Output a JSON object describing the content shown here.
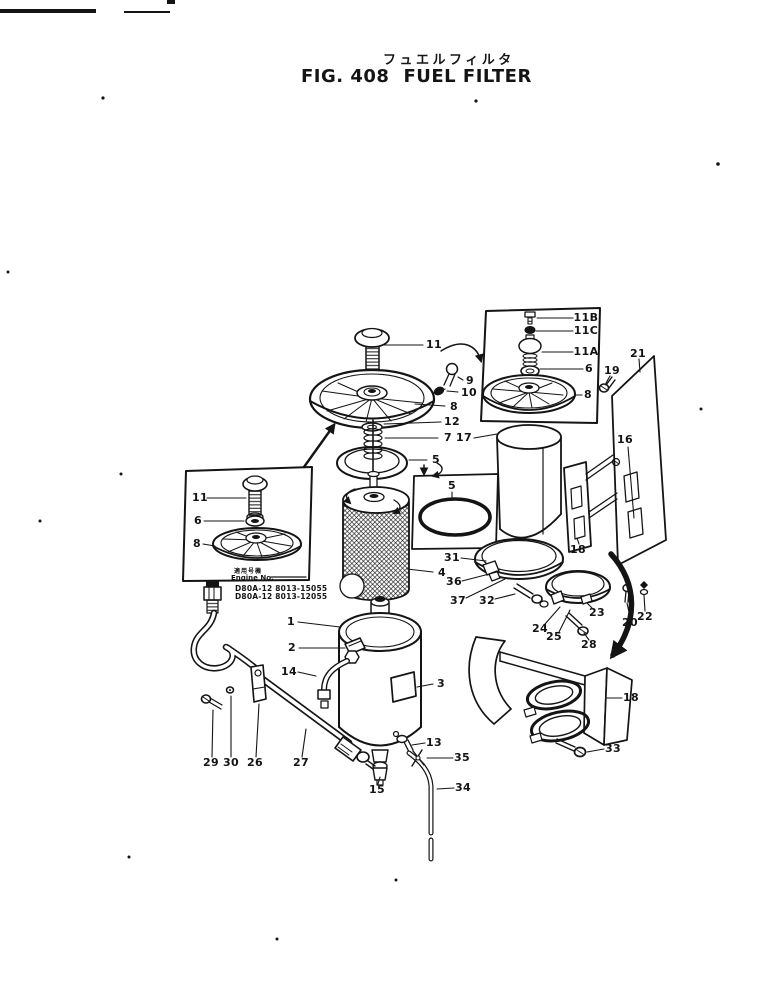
{
  "page": {
    "title_jp": "フュエルフィルタ",
    "fig_no": "FIG. 408",
    "title_en": "FUEL FILTER"
  },
  "engine_box": {
    "applicable_label": "適用号機",
    "engine_no_label": "Engine No.",
    "serials": [
      "D80A-12 8013-15055",
      "D80A-12 8013-12055"
    ]
  },
  "colors": {
    "ink": "#141414",
    "paper": "#ffffff"
  },
  "callouts": [
    {
      "t": "11",
      "x": 434,
      "y": 345,
      "l": [
        382,
        345,
        423,
        345
      ]
    },
    {
      "t": "9",
      "x": 470,
      "y": 381,
      "l": [
        458,
        377,
        463,
        380
      ]
    },
    {
      "t": "10",
      "x": 469,
      "y": 393,
      "l": [
        447,
        391,
        458,
        392
      ]
    },
    {
      "t": "8",
      "x": 454,
      "y": 407,
      "l": [
        415,
        404,
        445,
        406
      ]
    },
    {
      "t": "12",
      "x": 452,
      "y": 422,
      "l": [
        384,
        424,
        441,
        422
      ]
    },
    {
      "t": "7",
      "x": 448,
      "y": 438,
      "l": [
        385,
        438,
        438,
        438
      ]
    },
    {
      "t": "17",
      "x": 464,
      "y": 438,
      "l": [
        474,
        438,
        497,
        434
      ]
    },
    {
      "t": "5",
      "x": 436,
      "y": 460,
      "l": [
        409,
        460,
        427,
        460
      ]
    },
    {
      "t": "5",
      "x": 452,
      "y": 486,
      "l": [
        452,
        492,
        452,
        500
      ]
    },
    {
      "t": "4",
      "x": 442,
      "y": 573,
      "l": [
        407,
        569,
        433,
        572
      ]
    },
    {
      "t": "31",
      "x": 452,
      "y": 558,
      "l": [
        461,
        558,
        486,
        561
      ]
    },
    {
      "t": "36",
      "x": 454,
      "y": 582,
      "l": [
        462,
        581,
        497,
        572
      ]
    },
    {
      "t": "37",
      "x": 458,
      "y": 601,
      "l": [
        466,
        598,
        505,
        579
      ]
    },
    {
      "t": "32",
      "x": 487,
      "y": 601,
      "l": [
        495,
        599,
        515,
        594
      ]
    },
    {
      "t": "16",
      "x": 625,
      "y": 440,
      "l": [
        628,
        447,
        634,
        518
      ]
    },
    {
      "t": "18",
      "x": 578,
      "y": 550,
      "l": [
        579,
        544,
        577,
        538
      ]
    },
    {
      "t": "24",
      "x": 540,
      "y": 629,
      "l": [
        545,
        624,
        560,
        607
      ]
    },
    {
      "t": "25",
      "x": 554,
      "y": 637,
      "l": [
        559,
        632,
        570,
        610
      ]
    },
    {
      "t": "23",
      "x": 597,
      "y": 613,
      "l": [
        593,
        609,
        587,
        603
      ]
    },
    {
      "t": "28",
      "x": 589,
      "y": 645,
      "l": [
        589,
        640,
        584,
        633
      ]
    },
    {
      "t": "20",
      "x": 630,
      "y": 623,
      "l": [
        630,
        617,
        627,
        603
      ]
    },
    {
      "t": "22",
      "x": 645,
      "y": 617,
      "l": [
        645,
        611,
        644,
        595
      ]
    },
    {
      "t": "19",
      "x": 612,
      "y": 371,
      "l": [
        610,
        376,
        606,
        383
      ]
    },
    {
      "t": "21",
      "x": 638,
      "y": 354,
      "l": [
        639,
        359,
        640,
        372
      ]
    },
    {
      "t": "1",
      "x": 291,
      "y": 622,
      "l": [
        298,
        622,
        340,
        627
      ]
    },
    {
      "t": "2",
      "x": 292,
      "y": 648,
      "l": [
        299,
        648,
        345,
        648
      ]
    },
    {
      "t": "14",
      "x": 289,
      "y": 672,
      "l": [
        298,
        672,
        316,
        676
      ]
    },
    {
      "t": "3",
      "x": 441,
      "y": 684,
      "l": [
        433,
        684,
        417,
        687
      ]
    },
    {
      "t": "13",
      "x": 434,
      "y": 743,
      "l": [
        425,
        743,
        412,
        745
      ]
    },
    {
      "t": "35",
      "x": 462,
      "y": 758,
      "l": [
        453,
        758,
        427,
        758
      ]
    },
    {
      "t": "34",
      "x": 463,
      "y": 788,
      "l": [
        454,
        788,
        437,
        789
      ]
    },
    {
      "t": "15",
      "x": 377,
      "y": 790,
      "l": [
        378,
        784,
        380,
        777
      ]
    },
    {
      "t": "29",
      "x": 211,
      "y": 763,
      "l": [
        212,
        757,
        213,
        710
      ]
    },
    {
      "t": "30",
      "x": 231,
      "y": 763,
      "l": [
        231,
        757,
        231,
        696
      ]
    },
    {
      "t": "26",
      "x": 255,
      "y": 763,
      "l": [
        256,
        757,
        259,
        704
      ]
    },
    {
      "t": "27",
      "x": 301,
      "y": 763,
      "l": [
        302,
        757,
        306,
        729
      ]
    },
    {
      "t": "33",
      "x": 613,
      "y": 749,
      "l": [
        604,
        749,
        587,
        752
      ]
    },
    {
      "t": "18",
      "x": 631,
      "y": 698,
      "l": [
        622,
        698,
        607,
        698
      ]
    },
    {
      "t": "11",
      "x": 200,
      "y": 498,
      "s": 10,
      "l": [
        207,
        498,
        246,
        498
      ]
    },
    {
      "t": "6",
      "x": 198,
      "y": 521,
      "s": 10,
      "l": [
        204,
        521,
        244,
        521
      ]
    },
    {
      "t": "8",
      "x": 197,
      "y": 544,
      "s": 10,
      "l": [
        203,
        544,
        215,
        546
      ]
    },
    {
      "t": "11B",
      "x": 586,
      "y": 318,
      "s": 9.5,
      "l": [
        537,
        318,
        573,
        318
      ]
    },
    {
      "t": "11C",
      "x": 586,
      "y": 331,
      "s": 9.5,
      "l": [
        536,
        331,
        573,
        331
      ]
    },
    {
      "t": "11A",
      "x": 586,
      "y": 352,
      "s": 9.5,
      "l": [
        542,
        352,
        573,
        352
      ]
    },
    {
      "t": "6",
      "x": 589,
      "y": 369,
      "s": 10,
      "l": [
        540,
        369,
        583,
        369
      ]
    },
    {
      "t": "8",
      "x": 588,
      "y": 395,
      "s": 10,
      "l": [
        576,
        395,
        582,
        395
      ]
    }
  ]
}
